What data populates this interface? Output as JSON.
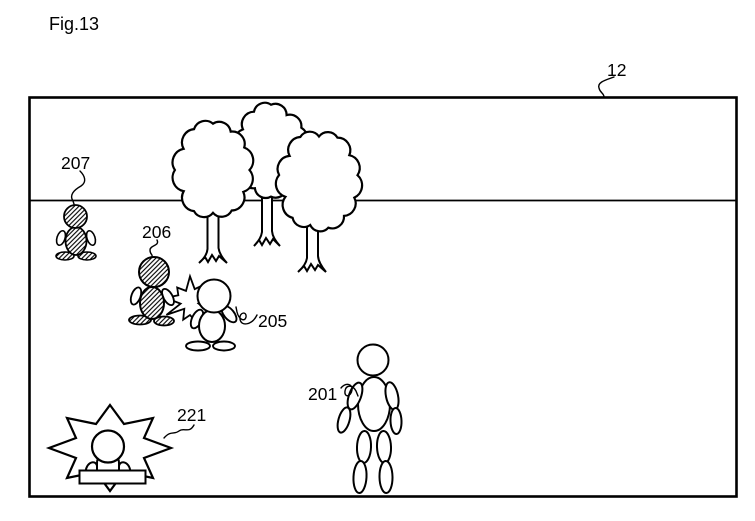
{
  "page": {
    "colors": {
      "ink": "#000000",
      "background": "#ffffff"
    }
  },
  "figure": {
    "caption": "Fig.13",
    "labels": {
      "ref_12": "12",
      "ref_207": "207",
      "ref_206": "206",
      "ref_205": "205",
      "ref_201": "201",
      "ref_221": "221"
    }
  }
}
